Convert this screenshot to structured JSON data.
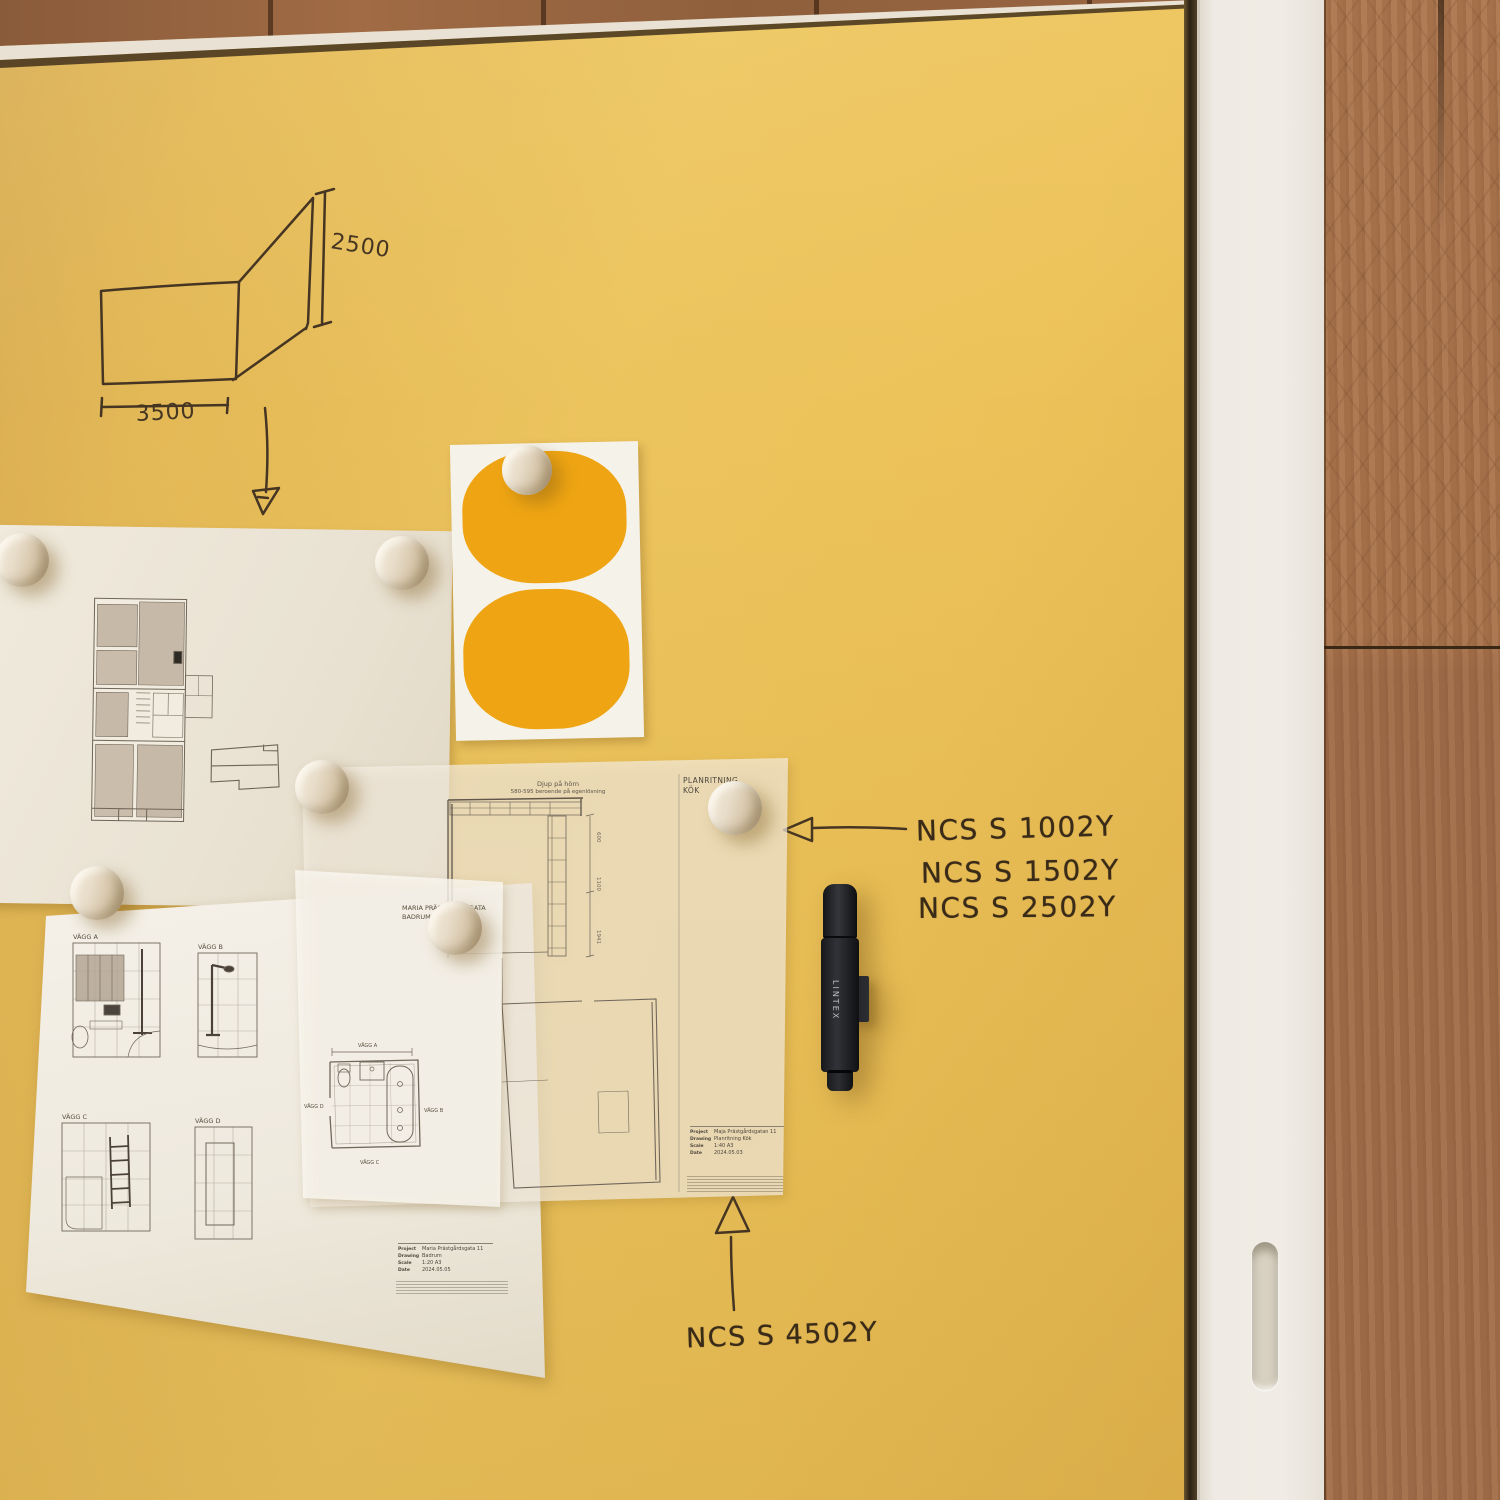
{
  "scene": {
    "setting": "Yellow glass writing board with pinned architectural drawings, round wooden magnets, a black marker, handwritten NCS colour codes; white cabinet frame and oak wall panelling on the right"
  },
  "handwriting": {
    "sketch": {
      "height_dim": "2500",
      "width_dim": "3500"
    },
    "ncs_group": [
      "NCS S 1002Y",
      "NCS S 1502Y",
      "NCS S 2502Y"
    ],
    "ncs_bottom": "NCS S 4502Y"
  },
  "marker": {
    "brand": "LINTEX"
  },
  "papers": {
    "kitchen": {
      "note_line1": "Djup på hörn",
      "note_line2": "580-595 beroende på egenlösning",
      "corner_title_line1": "PLANRITNING",
      "corner_title_line2": "KÖK",
      "dims": [
        "600",
        "1100",
        "1941"
      ],
      "title_block": {
        "labels": [
          "Project",
          "Drawing",
          "Scale",
          "Date"
        ],
        "values": [
          "Maja Prästgårdsgatan 11",
          "Planritning Kök",
          "1:40 A3",
          "2024.05.03"
        ]
      }
    },
    "bathroom_vellum": {
      "heading_line1": "MARIA PRÄSTGÅRDSGATA",
      "heading_line2": "BADRUM",
      "walls": {
        "top": "VÄGG A",
        "left": "VÄGG D",
        "right": "VÄGG B",
        "bottom": "VÄGG C"
      }
    },
    "elevations": {
      "labels": [
        "VÄGG A",
        "VÄGG B",
        "VÄGG C",
        "VÄGG D"
      ],
      "title_block": {
        "labels": [
          "Project",
          "Drawing",
          "Scale",
          "Date"
        ],
        "values": [
          "Maria Prästgårdsgata 11",
          "Badrum",
          "1:20 A3",
          "2024.05.05"
        ]
      }
    }
  },
  "colors": {
    "board_yellow": "#E8BF58",
    "sticker_orange": "#EFA513",
    "wood_panel": "#A8734E",
    "frame_white": "#EFEBE4",
    "magnet_wood": "#E6DAC6",
    "marker_black": "#1E2023",
    "ink": "#3A2B18"
  }
}
